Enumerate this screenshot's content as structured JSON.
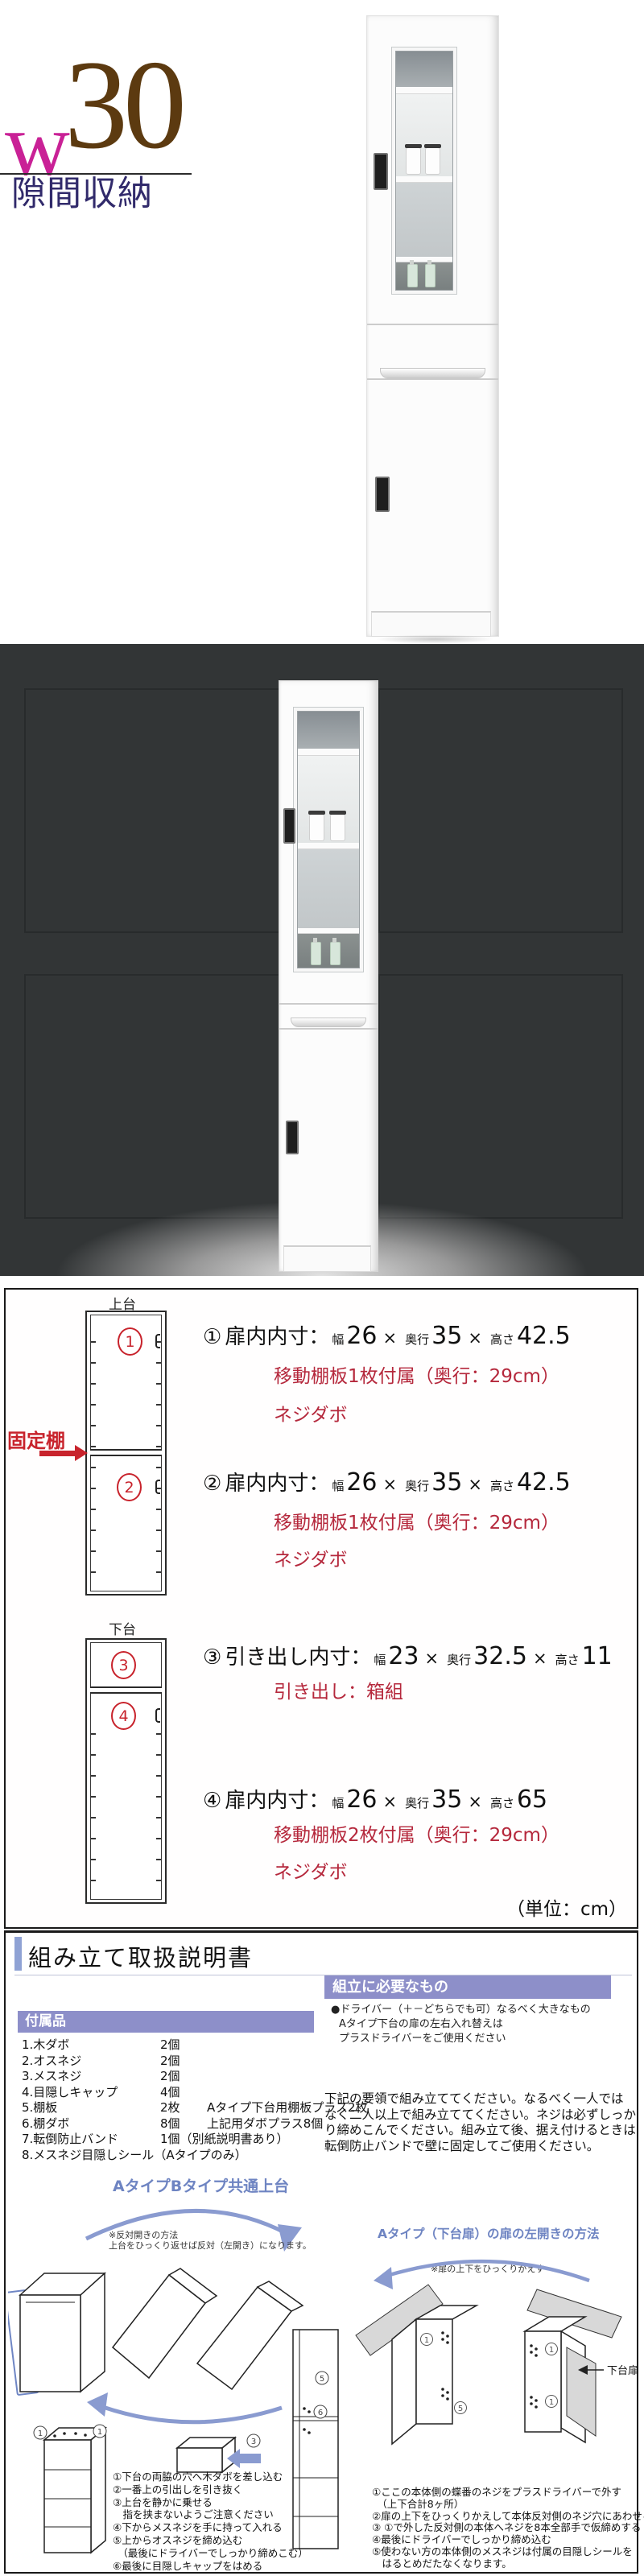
{
  "colors": {
    "logo_w": "#c92196",
    "logo_num": "#5c3a10",
    "subtitle": "#312a6b",
    "accent_red": "#b5283c",
    "circle_red": "#c8232c",
    "purple_header": "#8d8fc9",
    "title_bar_blue": "#8fa2d4",
    "diagram_blue": "#6e84c2",
    "dark_background": "#323536"
  },
  "logo": {
    "w": "w",
    "num": "30",
    "subtitle": "隙間収納"
  },
  "specs": {
    "times": "×",
    "upper_label": "上台",
    "lower_label": "下台",
    "fixed_shelf_label": "固定棚",
    "unit_note": "（単位：cm）",
    "items": [
      {
        "num": "①",
        "circle": "1",
        "label": "扉内内寸：",
        "d1u": "幅",
        "d1": "26",
        "d2u": "奥行",
        "d2": "35",
        "d3u": "高さ",
        "d3": "42.5",
        "note1": "移動棚板1枚付属（奥行：29cm）",
        "note2": "ネジダボ"
      },
      {
        "num": "②",
        "circle": "2",
        "label": "扉内内寸：",
        "d1u": "幅",
        "d1": "26",
        "d2u": "奥行",
        "d2": "35",
        "d3u": "高さ",
        "d3": "42.5",
        "note1": "移動棚板1枚付属（奥行：29cm）",
        "note2": "ネジダボ"
      },
      {
        "num": "③",
        "circle": "3",
        "label": "引き出し内寸：",
        "d1u": "幅",
        "d1": "23",
        "d2u": "奥行",
        "d2": "32.5",
        "d3u": "高さ",
        "d3": "11",
        "note1": "引き出し：箱組",
        "note2": ""
      },
      {
        "num": "④",
        "circle": "4",
        "label": "扉内内寸：",
        "d1u": "幅",
        "d1": "26",
        "d2u": "奥行",
        "d2": "35",
        "d3u": "高さ",
        "d3": "65",
        "note1": "移動棚板2枚付属（奥行：29cm）",
        "note2": "ネジダボ"
      }
    ]
  },
  "assembly": {
    "title": "組み立て取扱説明書",
    "needed": {
      "header": "組立に必要なもの",
      "line1": "●ドライバー（＋－どちらでも可）なるべく大きなもの",
      "line2": "Aタイプ下台の扉の左右入れ替えは",
      "line3": "プラスドライバーをご使用ください"
    },
    "accessories": {
      "header": "付属品",
      "rows": [
        {
          "name": "1.木ダボ",
          "qty": "2個",
          "note": ""
        },
        {
          "name": "2.オスネジ",
          "qty": "2個",
          "note": ""
        },
        {
          "name": "3.メスネジ",
          "qty": "2個",
          "note": ""
        },
        {
          "name": "4.目隠しキャップ",
          "qty": "4個",
          "note": ""
        },
        {
          "name": "5.棚板",
          "qty": "2枚",
          "note": "Aタイプ下台用棚板プラス2枚"
        },
        {
          "name": "6.棚ダボ",
          "qty": "8個",
          "note": "上記用ダボプラス8個"
        },
        {
          "name": "7.転倒防止バンド",
          "qty": "1個（別紙説明書あり）",
          "note": ""
        },
        {
          "name": "8.メスネジ目隠しシール（Aタイプのみ）",
          "qty": "",
          "note": ""
        }
      ]
    },
    "para": {
      "line1": "下記の要領で組み立ててください。なるべく一人では",
      "line2": "なく二人以上で組み立ててください。ネジは必ずしっか",
      "line3": "り締めこんでください。組み立て後、据え付けるときは",
      "line4": "転倒防止バンドで壁に固定してご使用ください。"
    },
    "left_diagram": {
      "heading": "AタイプBタイプ共通上台",
      "note1": "※反対開きの方法",
      "note2": "上台をひっくり返せば反対（左開き）になります。",
      "corner_label_left": "1",
      "corner_label_right": "1",
      "insert_label": "3",
      "junction_label_5": "5",
      "junction_label_6": "6",
      "steps": [
        "①下台の両脇の穴へ木ダボを差し込む",
        "②一番上の引出しを引き抜く",
        "③上台を静かに乗せる",
        "　指を挟まないようご注意ください",
        "④下からメスネジを手に持って入れる",
        "⑤上からオスネジを締め込む",
        "　（最後にドライバーでしっかり締めこむ）",
        "⑥最後に目隠しキャップをはめる"
      ]
    },
    "right_diagram": {
      "heading": "Aタイプ（下台扉）の扉の左開きの方法",
      "note": "※扉の上下をひっくりかえす",
      "door_label": "下台扉",
      "hinge_label_a": "1",
      "hinge_label_b": "1",
      "hinge_label_c": "5",
      "steps": [
        "①ここの本体側の蝶番のネジをプラスドライバーで外す",
        "　（上下合計8ヶ所）",
        "②扉の上下をひっくりかえして本体反対側のネジ穴にあわせる",
        "③ ①で外した反対側の本体へネジを8本全部手で仮締めする",
        "④最後にドライバーでしっかり締め込む",
        "⑤使わない方の本体側のメスネジは付属の目隠しシールを",
        "　はるとめだたなくなります。"
      ]
    }
  }
}
